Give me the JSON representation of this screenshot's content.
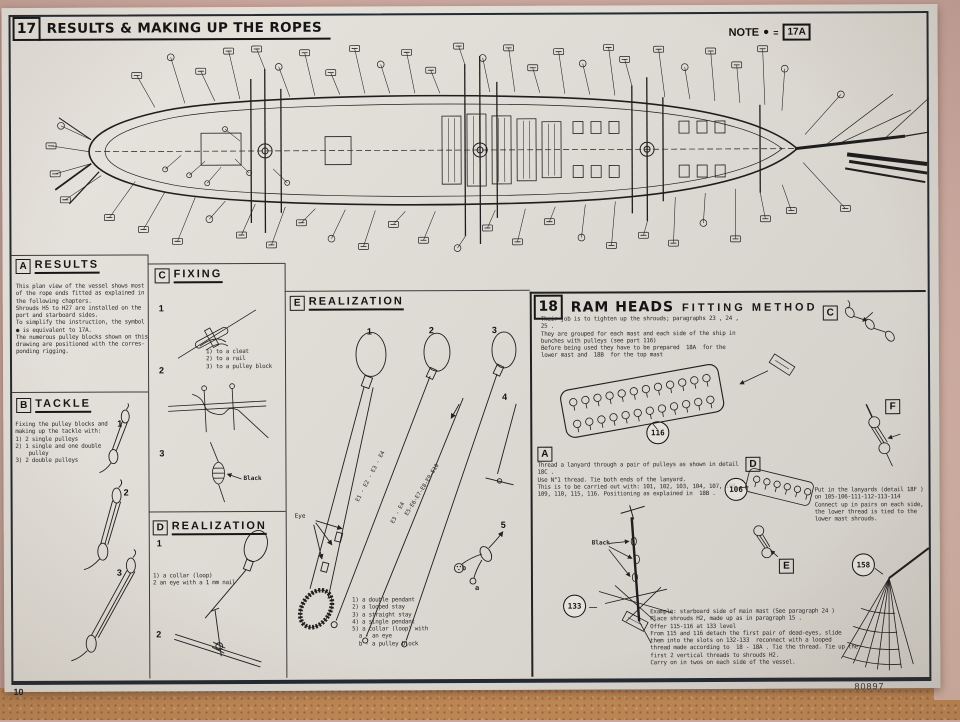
{
  "header": {
    "section_number": "17",
    "title": "RESULTS & MAKING UP THE ROPES",
    "note_label": "NOTE",
    "note_symbol": "●",
    "note_equals": "=",
    "note_ref": "17A"
  },
  "page": {
    "number": "10",
    "print_code": "80897"
  },
  "section_a": {
    "marker": "A",
    "title": "RESULTS",
    "body": "This plan view of the vessel shows most\nof the rope ends fitted as explained in\nthe following chapters.\nShrouds H5 to H27 are installed on the\nport and starboard sides.\nTo simplify the instruction, the symbol\n● is equivalent to 17A.\nThe numerous pulley blocks shown on this\ndrawing are positioned with the corres-\nponding rigging."
  },
  "section_b": {
    "marker": "B",
    "title": "TACKLE",
    "body": "Fixing the pulley blocks and\nmaking up the tackle with:\n1) 2 single pulleys\n2) 1 single and one double\n    pulley\n3) 2 double pulleys",
    "item_numbers": [
      "1",
      "2",
      "3"
    ]
  },
  "section_c": {
    "marker": "C",
    "title": "FIXING",
    "item_numbers": [
      "1",
      "2",
      "3"
    ],
    "legend": "1) to a cleat\n2) to a rail\n3) to a pulley block",
    "black_label": "Black"
  },
  "section_d": {
    "marker": "D",
    "title": "REALIZATION",
    "item_numbers": [
      "1",
      "2"
    ],
    "legend": "1) a collar (loop)\n2 an eye with a 1 mm nail"
  },
  "section_e": {
    "marker": "E",
    "title": "REALIZATION",
    "item_numbers": [
      "1",
      "2",
      "3",
      "4",
      "5"
    ],
    "eye_label": "Eye",
    "rope_labels": [
      "E1 - E2 - E3 - E4",
      "E3 - E4",
      "E5-E6-E7-E8-E9-E10"
    ],
    "end_label_a": "a",
    "end_label_b": "b",
    "legend": "1) a double pendant\n2) a looped stay\n3) a straight stay\n4) a single pendant\n5) a collar (loop) with\n  a - an eye\n  b - a pulley block"
  },
  "section_18": {
    "section_number": "18",
    "title": "RAM HEADS",
    "subtitle": "FITTING METHOD",
    "intro": "Their job is to tighten up the shrouds; paragraphs 23 , 24 ,\n25 .\nThey are grouped for each mast and each side of the ship in\nbunches with pulleys (see part 116)\nBefore being used they have to be prepared  18A  for the\nlower mast and  18B  for the top mast",
    "detail_a": "A",
    "detail_c": "C",
    "detail_d": "D",
    "detail_e": "E",
    "detail_f": "F",
    "part_116": "116",
    "part_106": "106",
    "part_158": "158",
    "part_133": "133",
    "thread_note": "Thread a lanyard through a pair of pulleys as shown in detail\n18C .\nUse N°1 thread. Tie both ends of the lanyard.\nThis is to be carried out with: 101, 102, 103, 104, 107, 108,\n109, 110, 115, 116. Positioning as explained in  18B .",
    "lanyards_note": "Put in the lanyards (detail 18F )\non 105-106-111-112-113-114\nConnect up in pairs on each side,\nthe lower thread is tied to the\nlower mast shrouds.",
    "black_label": "Black",
    "example": "Example: starboard side of main mast (See paragraph 24 )\nPlace shrouds H2, made up as in paragraph 15 .\nOffer 115-116 at 133 level\nFrom 115 and 116 detach the first pair of dead-eyes, slide\nthem into the slots on 132-133  reconnect with a looped\nthread made according to  18 - 18A . Tie the thread. Tie up the\nfirst 2 vertical threads to shrouds H2.\nCarry on in twos on each side of the vessel."
  },
  "colors": {
    "ink": "#1c1c1c",
    "paper": "#dedbd4"
  }
}
